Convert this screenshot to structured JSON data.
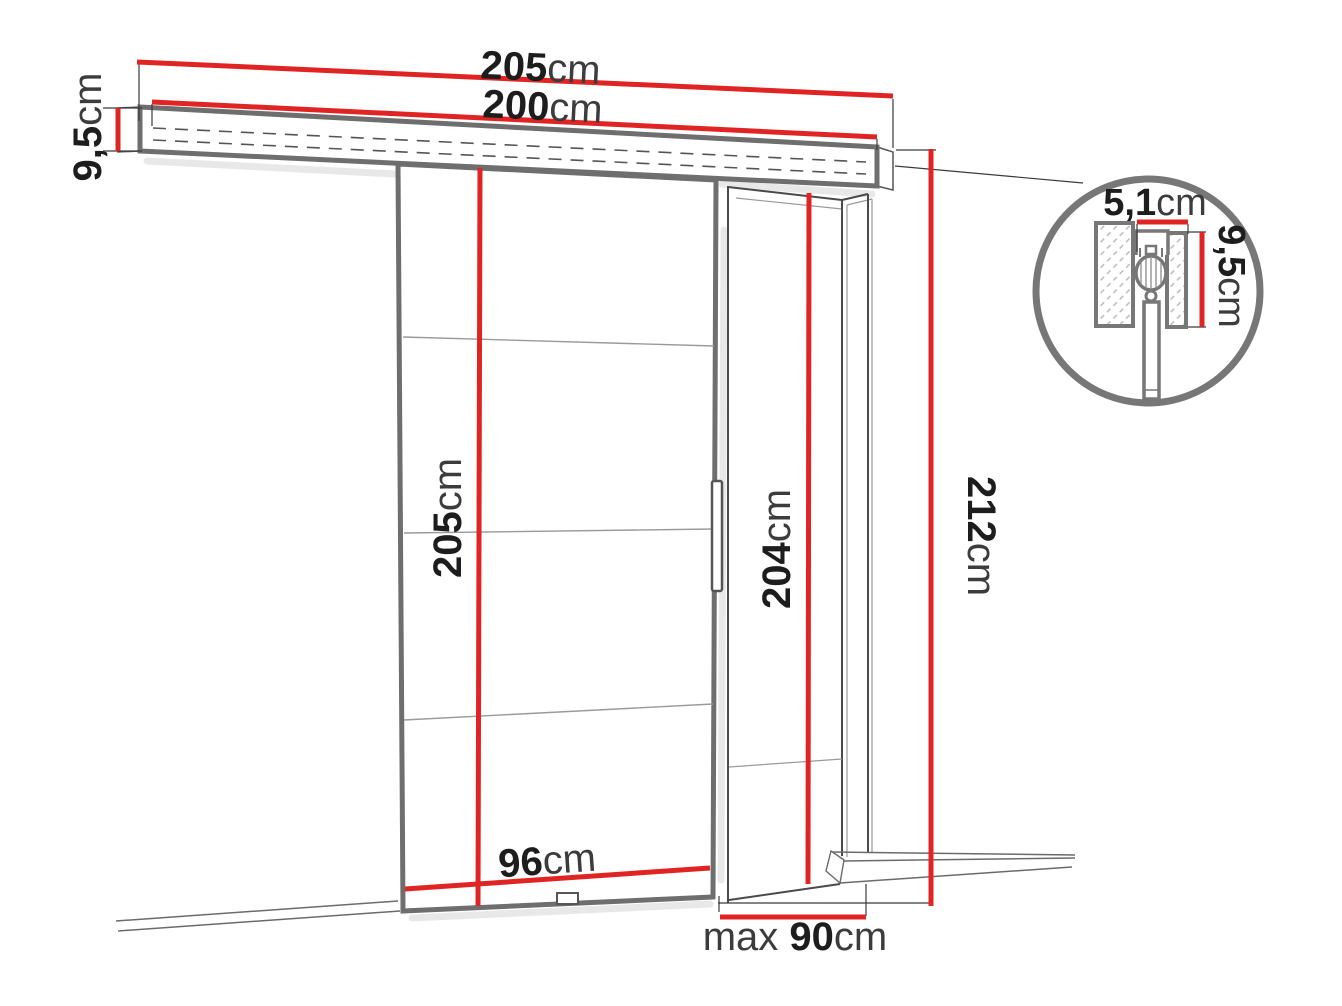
{
  "diagram": {
    "colors": {
      "accent": "#e02423",
      "outline": "#6e6e6e",
      "detail": "#777777",
      "ink": "#1d1d1d",
      "ink-soft": "#3c3c3c"
    },
    "labels": {
      "track_outer": {
        "value": "205",
        "unit": "cm"
      },
      "track_inner": {
        "value": "200",
        "unit": "cm"
      },
      "track_height": {
        "value": "9,5",
        "unit": "cm"
      },
      "door_height": {
        "value": "205",
        "unit": "cm"
      },
      "door_width": {
        "value": "96",
        "unit": "cm"
      },
      "opening_height": {
        "value": "204",
        "unit": "cm"
      },
      "total_height": {
        "value": "212",
        "unit": "cm"
      },
      "opening_width": {
        "prefix": "max ",
        "value": "90",
        "unit": "cm"
      },
      "detail_width": {
        "value": "5,1",
        "unit": "cm"
      },
      "detail_height": {
        "value": "9,5",
        "unit": "cm"
      }
    }
  }
}
